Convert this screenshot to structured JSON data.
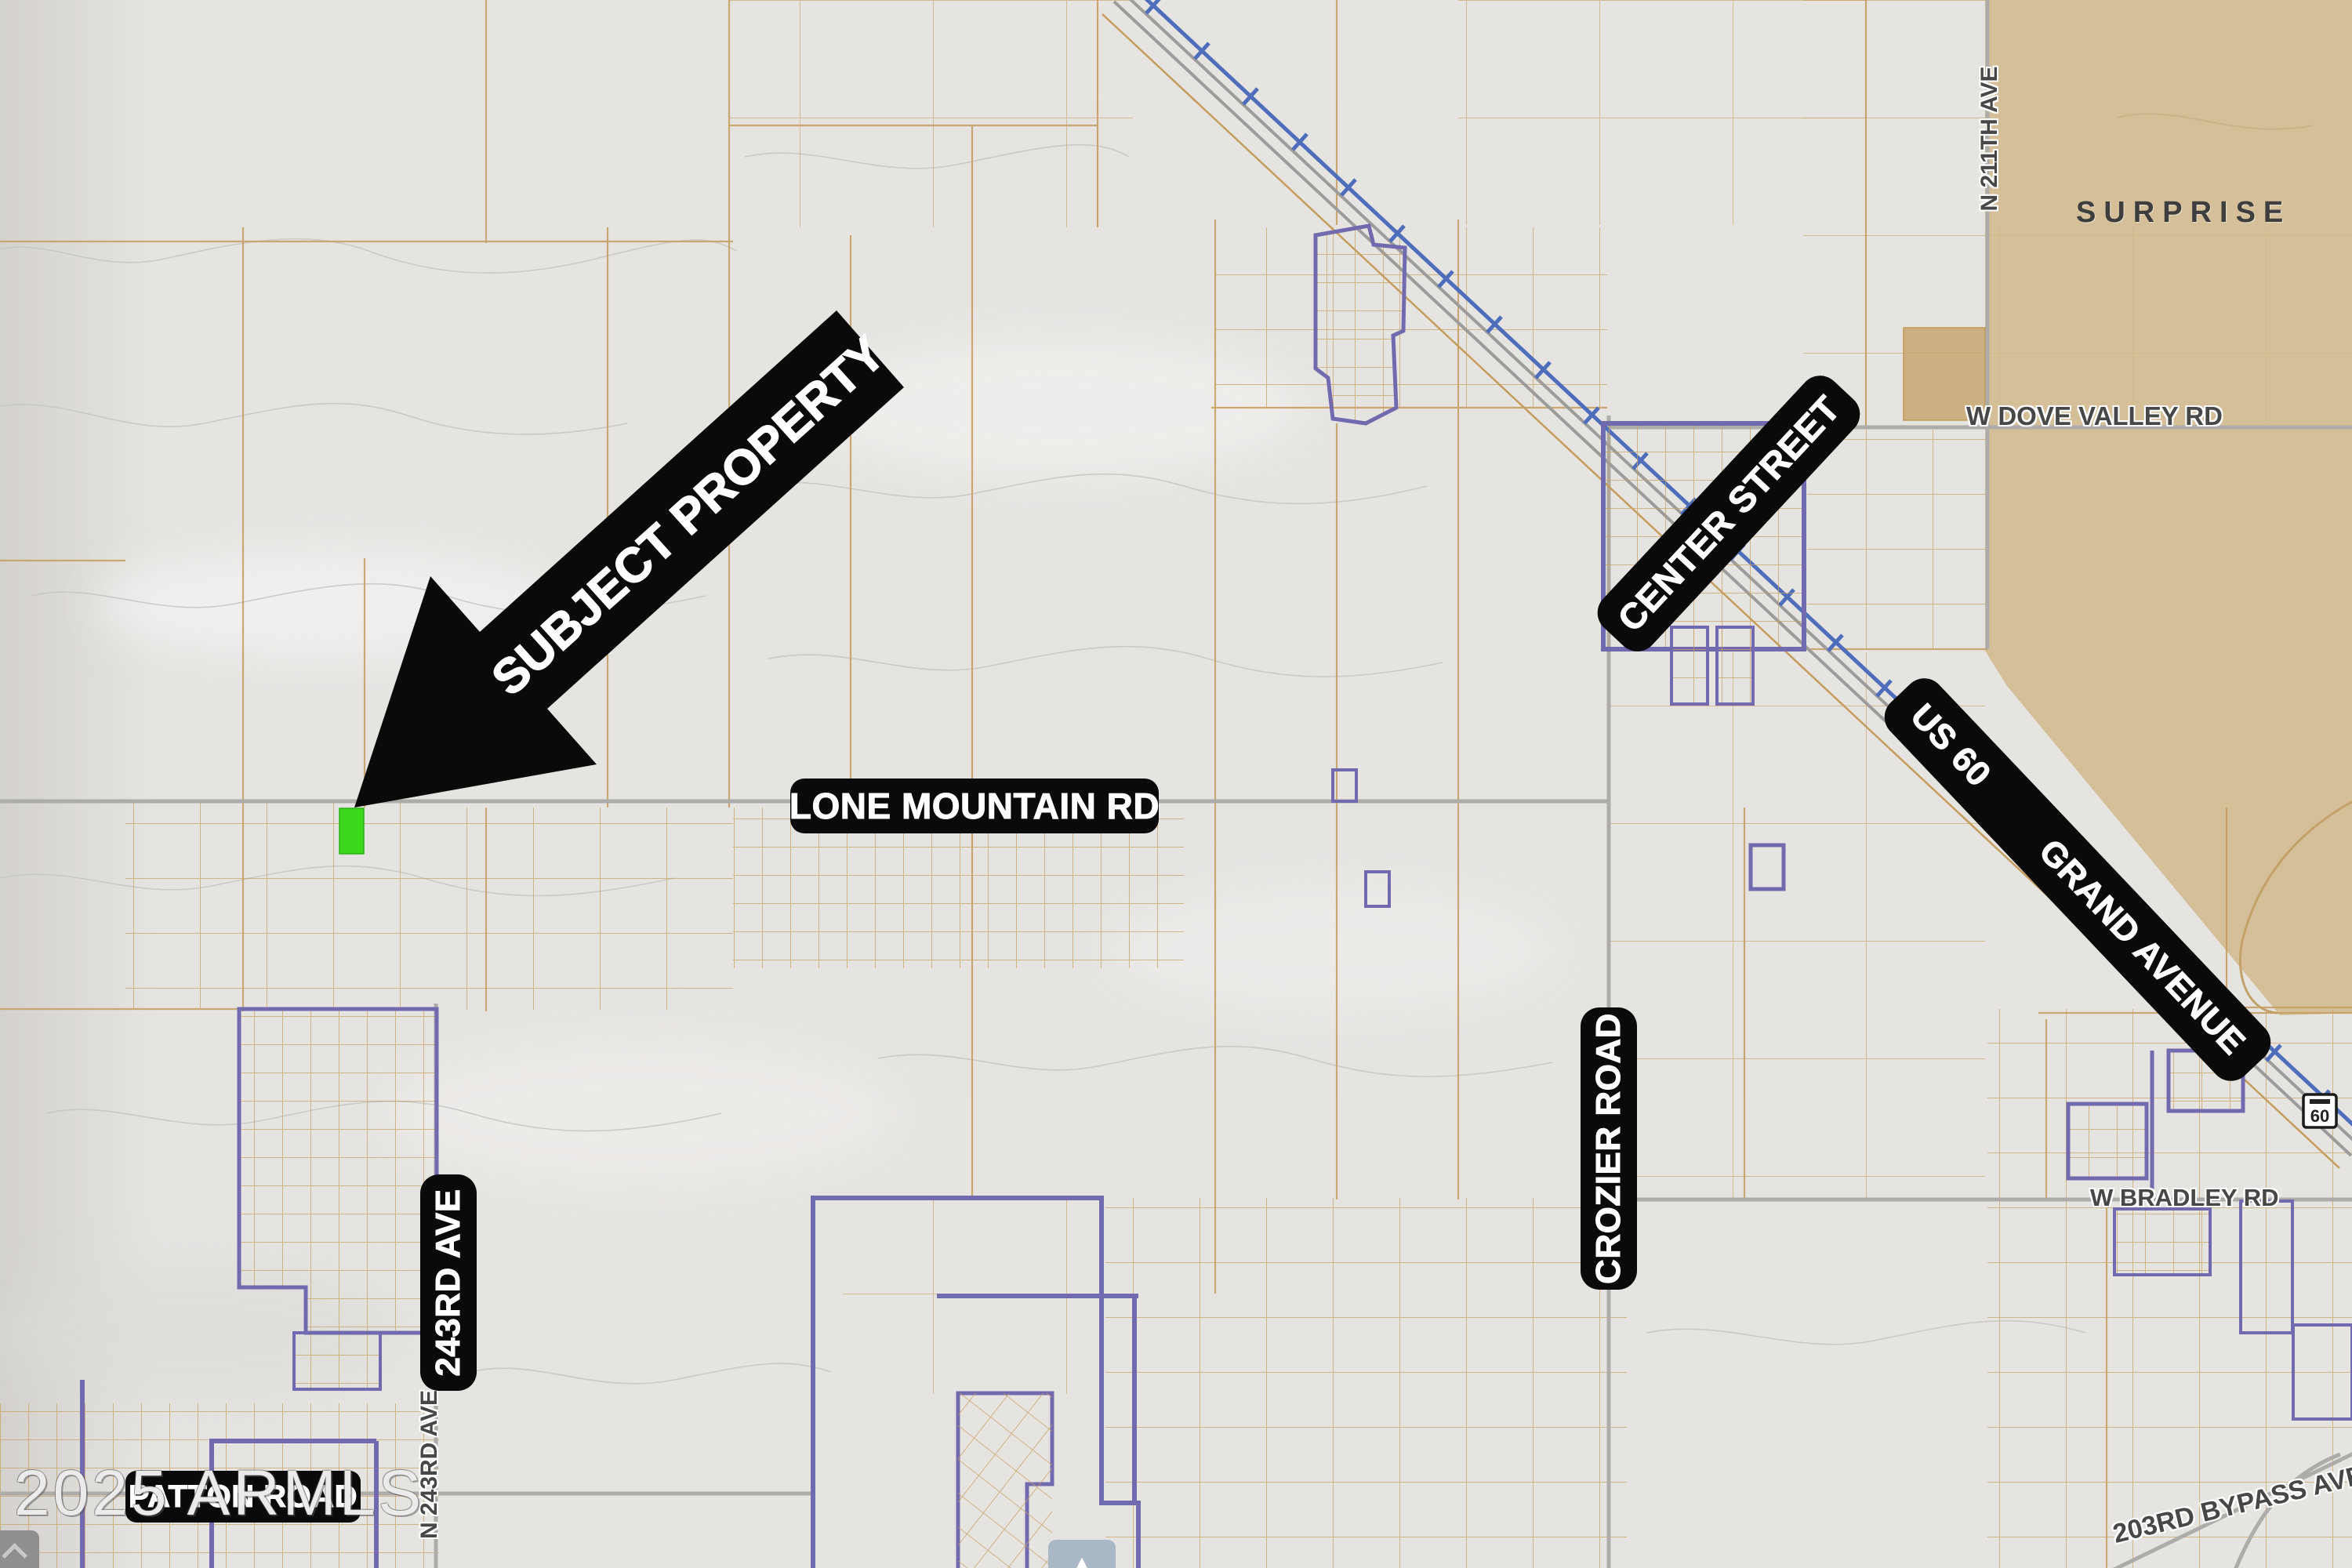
{
  "map": {
    "watermark": "2025 ARMLS",
    "city": "SURPRISE",
    "arrow_label": "SUBJECT PROPERTY",
    "road_banners": {
      "lone_mountain": "LONE MOUNTAIN RD",
      "center_street": "CENTER STREET",
      "us_60": "US 60",
      "grand_avenue": "GRAND AVENUE",
      "crozier_road": "CROZIER ROAD",
      "ave_243rd": "243RD AVE",
      "patton_road": "PATTON ROAD"
    },
    "street_labels": {
      "dove_valley": "W DOVE VALLEY RD",
      "bradley": "W BRADLEY RD",
      "ave_211th": "N 211TH AVE",
      "ave_243rd_minor": "N 243RD AVE",
      "bypass_203rd": "203RD BYPASS AVE"
    },
    "route_shield": "60",
    "pan_up_glyph": "▲",
    "colors": {
      "subject_parcel": "#3bd71d",
      "city_fill": "#d5bf99",
      "parcel_line": "#c79f5f",
      "boundary_purple": "#716aaf",
      "railroad_blue": "#4e6ebc",
      "label_bg": "#0a0a0a"
    }
  }
}
